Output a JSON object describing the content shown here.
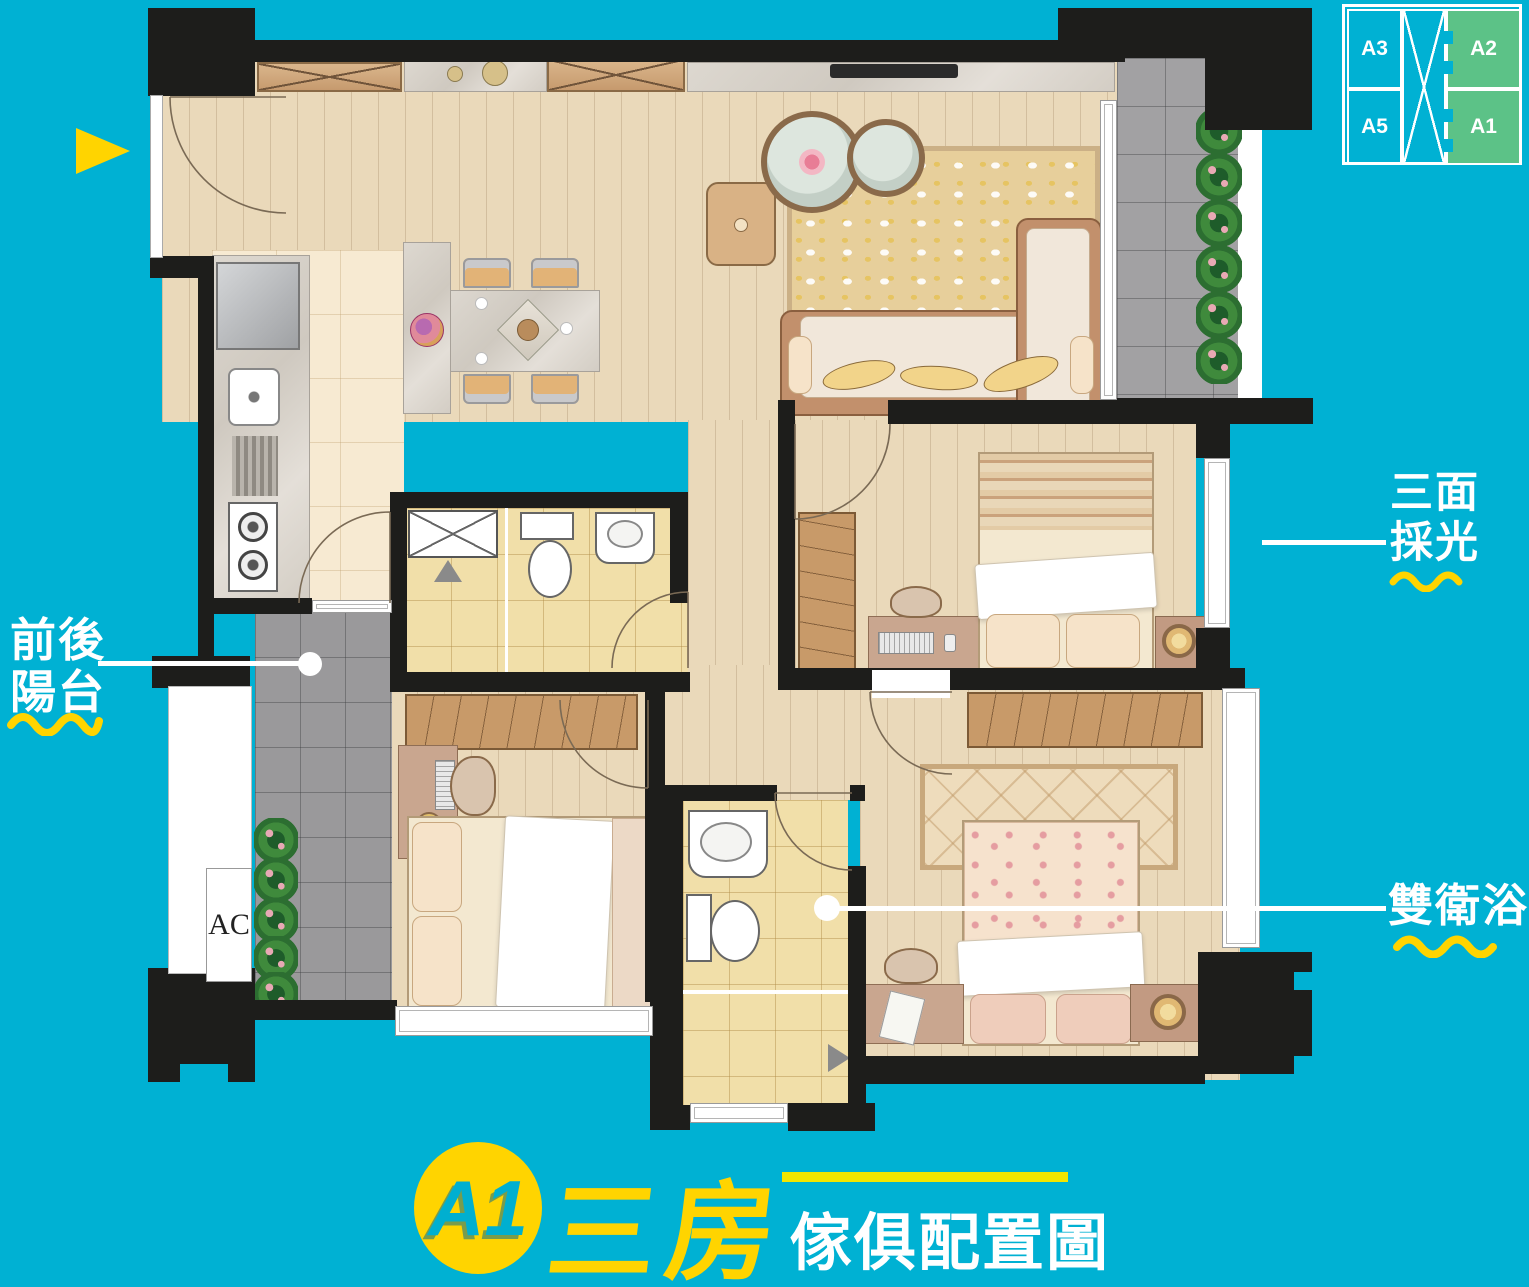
{
  "colors": {
    "background": "#00b1d3",
    "accent_yellow": "#ffd400",
    "highlight_green": "#5cc287",
    "wall_black": "#1d1d1b",
    "title_line_yellow": "#f2e600",
    "callout_text": "#ffffff"
  },
  "key_plan": {
    "cells": [
      {
        "label": "A3",
        "highlighted": false
      },
      {
        "label": "A2",
        "highlighted": true
      },
      {
        "label": "A5",
        "highlighted": false
      },
      {
        "label": "A1",
        "highlighted": true
      }
    ]
  },
  "callouts": {
    "front_rear_balcony": {
      "line1": "前後",
      "line2": "陽台"
    },
    "three_side_daylight": {
      "line1": "三面",
      "line2": "採光"
    },
    "double_bathroom": {
      "text": "雙衛浴"
    }
  },
  "plan": {
    "ac_label": "AC"
  },
  "title": {
    "badge": "A1",
    "headline": "三房",
    "subtitle": "傢俱配置圖"
  },
  "icons": {
    "entry_arrow": "yellow-right-triangle",
    "leader_dot": "white-circle",
    "shower_marker": "gray-triangle",
    "key_plan_core": "x-cross"
  }
}
